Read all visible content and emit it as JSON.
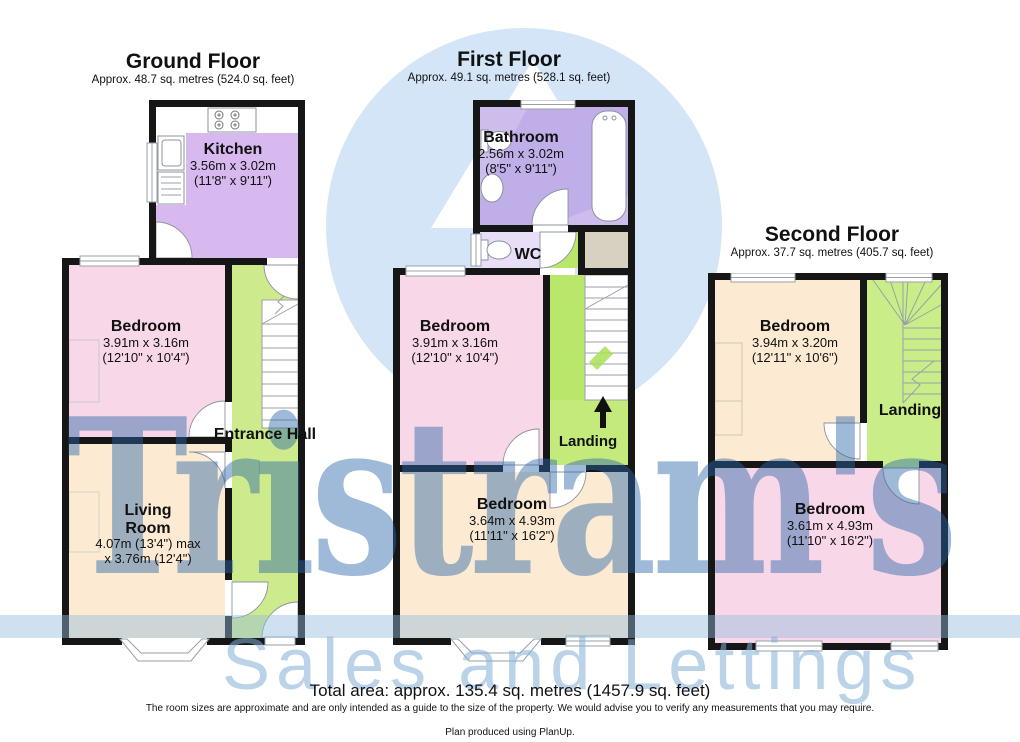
{
  "watermark": {
    "brand": "Tristram's",
    "tagline": "Sales and Lettings"
  },
  "floors": [
    {
      "id": "ground",
      "title": "Ground Floor",
      "subtitle": "Approx. 48.7 sq. metres (524.0 sq. feet)",
      "rooms": [
        {
          "name": "Kitchen",
          "dims": "3.56m x 3.02m",
          "dims_ft": "(11'8\" x 9'11\")"
        },
        {
          "name": "Bedroom",
          "dims": "3.91m x 3.16m",
          "dims_ft": "(12'10\" x 10'4\")"
        },
        {
          "name": "Entrance Hall"
        },
        {
          "name": "Living Room",
          "dims": "4.07m (13'4\") max",
          "dims_ft": "x 3.76m (12'4\")"
        }
      ]
    },
    {
      "id": "first",
      "title": "First Floor",
      "subtitle": "Approx. 49.1 sq. metres (528.1 sq. feet)",
      "rooms": [
        {
          "name": "Bathroom",
          "dims": "2.56m x 3.02m",
          "dims_ft": "(8'5\" x 9'11\")"
        },
        {
          "name": "WC"
        },
        {
          "name": "Bedroom",
          "dims": "3.91m x 3.16m",
          "dims_ft": "(12'10\" x 10'4\")"
        },
        {
          "name": "Landing"
        },
        {
          "name": "Bedroom",
          "dims": "3.64m x 4.93m",
          "dims_ft": "(11'11\" x 16'2\")"
        }
      ]
    },
    {
      "id": "second",
      "title": "Second Floor",
      "subtitle": "Approx. 37.7 sq. metres (405.7 sq. feet)",
      "rooms": [
        {
          "name": "Bedroom",
          "dims": "3.94m x 3.20m",
          "dims_ft": "(12'11\" x 10'6\")"
        },
        {
          "name": "Landing"
        },
        {
          "name": "Bedroom",
          "dims": "3.61m x 4.93m",
          "dims_ft": "(11'10\" x 16'2\")"
        }
      ]
    }
  ],
  "footer": {
    "total_area": "Total area: approx. 135.4 sq. metres (1457.9 sq. feet)",
    "disclaimer": "The room sizes are approximate and are only intended as a guide to the size of the property. We would advise you to verify any measurements that you may require.",
    "produced": "Plan produced using PlanUp."
  },
  "colors": {
    "wall": "#161616",
    "kitchen_purple": "#d7b9ef",
    "bathroom_purple": "#cdbdec",
    "wc_lavender": "#e8def7",
    "bedroom_pink": "#f8d7e8",
    "living_cream": "#fcebd2",
    "hall_green": "#cdeb8d",
    "corridor_green": "#b9e76b",
    "landing_green": "#c9ee89",
    "closet_beige": "#d8d1c1",
    "brand_blue": "#2a66a8",
    "logo_light_blue": "#d3e5f6"
  }
}
